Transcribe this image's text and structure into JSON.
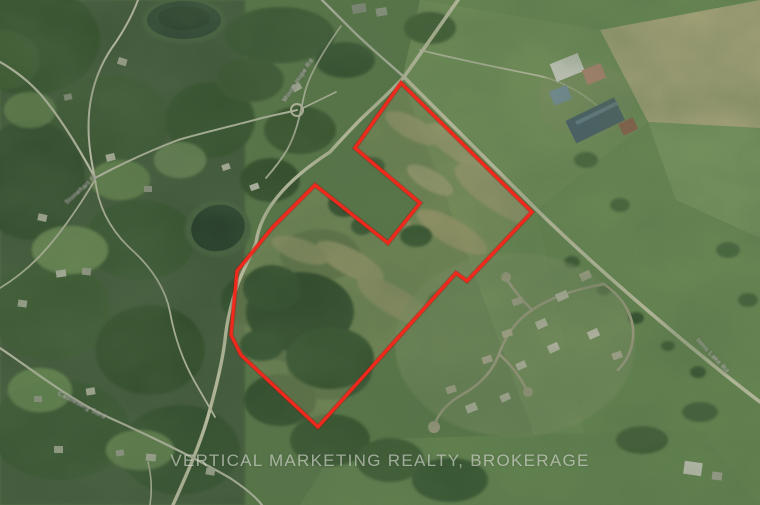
{
  "watermark": {
    "text": "VERTICAL MARKETING REALTY, BROKERAGE"
  },
  "map": {
    "boundary": {
      "color": "#f1281b",
      "points": [
        [
          401,
          83
        ],
        [
          532,
          212
        ],
        [
          467,
          281
        ],
        [
          456,
          273
        ],
        [
          318,
          427
        ],
        [
          241,
          355
        ],
        [
          231,
          335
        ],
        [
          237,
          271
        ],
        [
          272,
          228
        ],
        [
          315,
          185
        ],
        [
          388,
          243
        ],
        [
          420,
          203
        ],
        [
          355,
          148
        ]
      ]
    },
    "road_labels": [
      {
        "text": "Mount Hope Rd",
        "x": 284,
        "y": 98,
        "angle": -56
      },
      {
        "text": "Innis Lake Rd",
        "x": 697,
        "y": 336,
        "angle": 47
      },
      {
        "text": "Castlederg Sdrd",
        "x": 58,
        "y": 390,
        "angle": 27
      },
      {
        "text": "Stonehart St",
        "x": 66,
        "y": 200,
        "angle": -42
      }
    ],
    "palette": {
      "field_green": "#6f9155",
      "forest_green": "#2f4a2a",
      "scrub_tan": "#b2a97c",
      "road": "#e8e1c6",
      "tan_field": "#c9bc8e",
      "pond": "#23382c",
      "boundary_red": "#f1281b"
    }
  }
}
